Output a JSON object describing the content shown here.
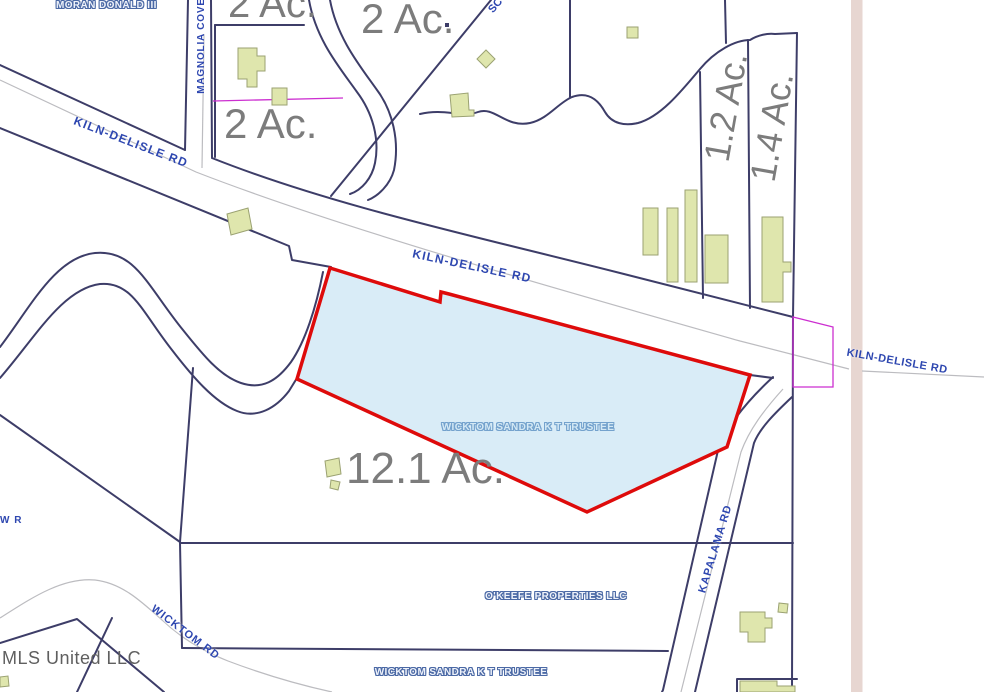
{
  "map": {
    "watermark": "MLS United LLC",
    "highlight_parcel": {
      "owner": "WICKTOM SANDRA K T TRUSTEE",
      "acreage": "12.1 Ac."
    },
    "acreage_labels": {
      "top_left": "2 Ac.",
      "mid_left": "2 Ac.",
      "top_center": "2 Ac.",
      "strip_narrow": "1.2 Ac.",
      "strip_wide": "1.4 Ac."
    },
    "road_labels": {
      "kiln_delisle_west": "KILN-DELISLE RD",
      "kiln_delisle_center": "KILN-DELISLE RD",
      "kiln_delisle_east": "KILN-DELISLE RD",
      "magnolia_cove": "MAGNOLIA COVE",
      "kapalama": "KAPALAMA RD",
      "wicktom": "WICKTOM RD",
      "partial_top": "SC",
      "partial_west": "W R"
    },
    "owner_labels": {
      "moran": "MORAN DONALD III",
      "okeefe": "O'KEEFE PROPERTIES LLC",
      "wicktom_south": "WICKTOM SANDRA K T TRUSTEE"
    },
    "colors": {
      "highlight_fill": "#d9ecf7",
      "highlight_outline": "#de0b0b",
      "parcel_line": "#3d3d68",
      "road_centerline": "#bcbcc0",
      "building_fill": "#dfe6ad",
      "building_outline": "#9ba272",
      "annotation_magenta": "#cc2fd0",
      "acreage_text": "#7c7c7c",
      "road_text": "#2e47b0",
      "owner_outline": "#4b69a5",
      "boundary_stripe": "#e7d6d1"
    }
  }
}
